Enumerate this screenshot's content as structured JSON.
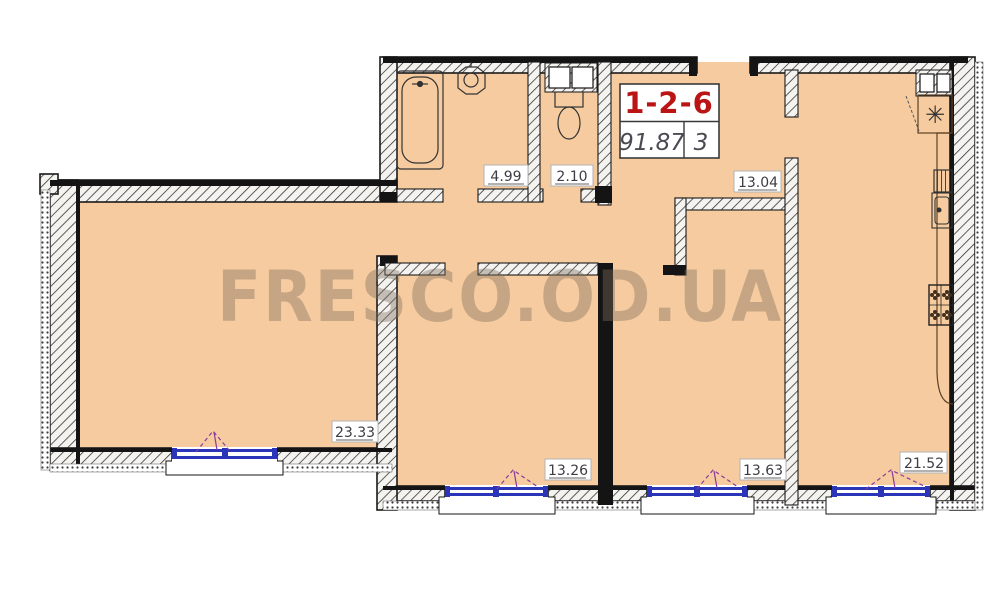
{
  "watermark": "FRESCO.OD.UA",
  "unit_label": {
    "number": "1-2-6",
    "total_area": "91.87",
    "room_count": "3"
  },
  "rooms": {
    "living": {
      "area": "23.33"
    },
    "bathroom": {
      "area": "4.99"
    },
    "wc": {
      "area": "2.10"
    },
    "hallway": {
      "area": "13.04"
    },
    "bedroom1": {
      "area": "13.26"
    },
    "bedroom2": {
      "area": "13.63"
    },
    "kitchen": {
      "area": "21.52"
    }
  },
  "colors": {
    "floor": "#F6CB9F",
    "wall": "#141414",
    "window": "#2B35B8",
    "unit_number": "#BB1414",
    "label_text": "#3C3C44",
    "watermark": "#7D6F5E",
    "opening_dash": "#8A3B9A"
  }
}
